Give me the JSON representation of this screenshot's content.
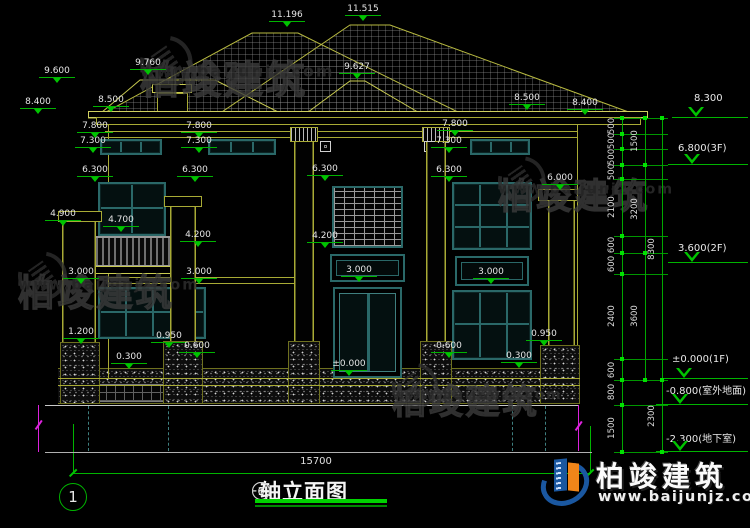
{
  "title": {
    "axis_from": "1",
    "separator": "-",
    "axis_to": "6",
    "text": "轴立面图"
  },
  "axis_bubble": "1",
  "overall_width": "15700",
  "watermark": {
    "name": "柏竣建筑",
    "url": "www.baijunjz.com"
  },
  "brand": {
    "name": "柏竣建筑",
    "url": "www.baijunjz.com"
  },
  "colors": {
    "line_yellow": "#a8aa35",
    "window_teal": "#2a6868",
    "dim_green": "#00c400",
    "text_white": "#e6e6e6",
    "brand_blue": "#1a57a0",
    "brand_orange": "#f08519",
    "break_magenta": "#dd22dd"
  },
  "roof_labels": [
    {
      "t": "11.196",
      "cx": 287,
      "cy": 16
    },
    {
      "t": "11.515",
      "cx": 363,
      "cy": 10
    },
    {
      "t": "9.600",
      "cx": 57,
      "cy": 72
    },
    {
      "t": "9.760",
      "cx": 148,
      "cy": 64
    },
    {
      "t": "9.627",
      "cx": 357,
      "cy": 68
    },
    {
      "t": "8.400",
      "cx": 38,
      "cy": 103
    },
    {
      "t": "8.500",
      "cx": 111,
      "cy": 101
    },
    {
      "t": "8.500",
      "cx": 527,
      "cy": 99
    },
    {
      "t": "8.400",
      "cx": 585,
      "cy": 104
    }
  ],
  "facade_labels": [
    {
      "t": "7.800",
      "cx": 95,
      "cy": 127
    },
    {
      "t": "7.800",
      "cx": 199,
      "cy": 127
    },
    {
      "t": "7.800",
      "cx": 455,
      "cy": 125
    },
    {
      "t": "7.300",
      "cx": 93,
      "cy": 142
    },
    {
      "t": "7.300",
      "cx": 199,
      "cy": 142
    },
    {
      "t": "7.300",
      "cx": 449,
      "cy": 142
    },
    {
      "t": "6.300",
      "cx": 95,
      "cy": 171
    },
    {
      "t": "6.300",
      "cx": 195,
      "cy": 171
    },
    {
      "t": "6.300",
      "cx": 325,
      "cy": 170
    },
    {
      "t": "6.300",
      "cx": 449,
      "cy": 171
    },
    {
      "t": "6.000",
      "cx": 560,
      "cy": 179
    },
    {
      "t": "4.900",
      "cx": 63,
      "cy": 215
    },
    {
      "t": "4.700",
      "cx": 121,
      "cy": 221
    },
    {
      "t": "4.200",
      "cx": 198,
      "cy": 236
    },
    {
      "t": "4.200",
      "cx": 325,
      "cy": 237
    },
    {
      "t": "3.000",
      "cx": 81,
      "cy": 273
    },
    {
      "t": "3.000",
      "cx": 199,
      "cy": 273
    },
    {
      "t": "3.000",
      "cx": 359,
      "cy": 271
    },
    {
      "t": "3.000",
      "cx": 491,
      "cy": 273
    },
    {
      "t": "1.200",
      "cx": 81,
      "cy": 333
    },
    {
      "t": "0.950",
      "cx": 169,
      "cy": 337
    },
    {
      "t": "0.950",
      "cx": 544,
      "cy": 335
    },
    {
      "t": "0.600",
      "cx": 197,
      "cy": 347
    },
    {
      "t": "0.600",
      "cx": 449,
      "cy": 347
    },
    {
      "t": "0.300",
      "cx": 129,
      "cy": 358
    },
    {
      "t": "0.300",
      "cx": 519,
      "cy": 357
    },
    {
      "t": "±0.000",
      "cx": 349,
      "cy": 365
    }
  ],
  "levels": [
    {
      "t": "8.300",
      "tx": 694,
      "ty": 93,
      "ly": 117,
      "lx1": 672
    },
    {
      "t": "6.800(3F)",
      "tx": 678,
      "ty": 143,
      "ly": 164,
      "lx1": 668
    },
    {
      "t": "3.600(2F)",
      "tx": 678,
      "ty": 243,
      "ly": 262,
      "lx1": 668
    },
    {
      "t": "±0.000(1F)",
      "tx": 672,
      "ty": 354,
      "ly": 378,
      "lx1": 660
    },
    {
      "t": "-0.800(室外地面)",
      "tx": 666,
      "ty": 382,
      "ly": 404,
      "lx1": 656
    },
    {
      "t": "-2.300(地下室)",
      "tx": 666,
      "ty": 430,
      "ly": 451,
      "lx1": 656
    }
  ],
  "chain": {
    "cols": [
      {
        "x": 622,
        "y1": 118,
        "y2": 452,
        "lx": 612,
        "labels": [
          {
            "t": "500",
            "y": 126
          },
          {
            "t": "500",
            "y": 141
          },
          {
            "t": "500",
            "y": 157
          },
          {
            "t": "500",
            "y": 172
          },
          {
            "t": "2100",
            "y": 207
          },
          {
            "t": "600",
            "y": 245
          },
          {
            "t": "600",
            "y": 264
          },
          {
            "t": "2400",
            "y": 316
          },
          {
            "t": "600",
            "y": 370
          },
          {
            "t": "800",
            "y": 392
          },
          {
            "t": "1500",
            "y": 428
          }
        ],
        "ticks": [
          118,
          134,
          149,
          165,
          179,
          236,
          253,
          274,
          359,
          380,
          405,
          452
        ]
      },
      {
        "x": 645,
        "y1": 118,
        "y2": 380,
        "lx": 635,
        "labels": [
          {
            "t": "1500",
            "y": 141
          },
          {
            "t": "3200",
            "y": 209
          },
          {
            "t": "3600",
            "y": 316
          }
        ],
        "ticks": [
          118,
          165,
          253,
          380
        ]
      },
      {
        "x": 662,
        "y1": 118,
        "y2": 452,
        "lx": 652,
        "labels": [
          {
            "t": "8300",
            "y": 249
          },
          {
            "t": "2300",
            "y": 416
          }
        ],
        "ticks": [
          118,
          380,
          452
        ]
      }
    ],
    "hline_x1": 614,
    "hline_x2": 668,
    "hlines": [
      118,
      134,
      149,
      165,
      179,
      236,
      253,
      274,
      359,
      380,
      405,
      452
    ]
  },
  "watermark_spots": [
    {
      "x": 140,
      "y": 62,
      "s": 1.05
    },
    {
      "x": 498,
      "y": 180,
      "s": 0.95
    },
    {
      "x": 18,
      "y": 276,
      "s": 0.98
    },
    {
      "x": 392,
      "y": 386,
      "s": 0.92
    }
  ]
}
